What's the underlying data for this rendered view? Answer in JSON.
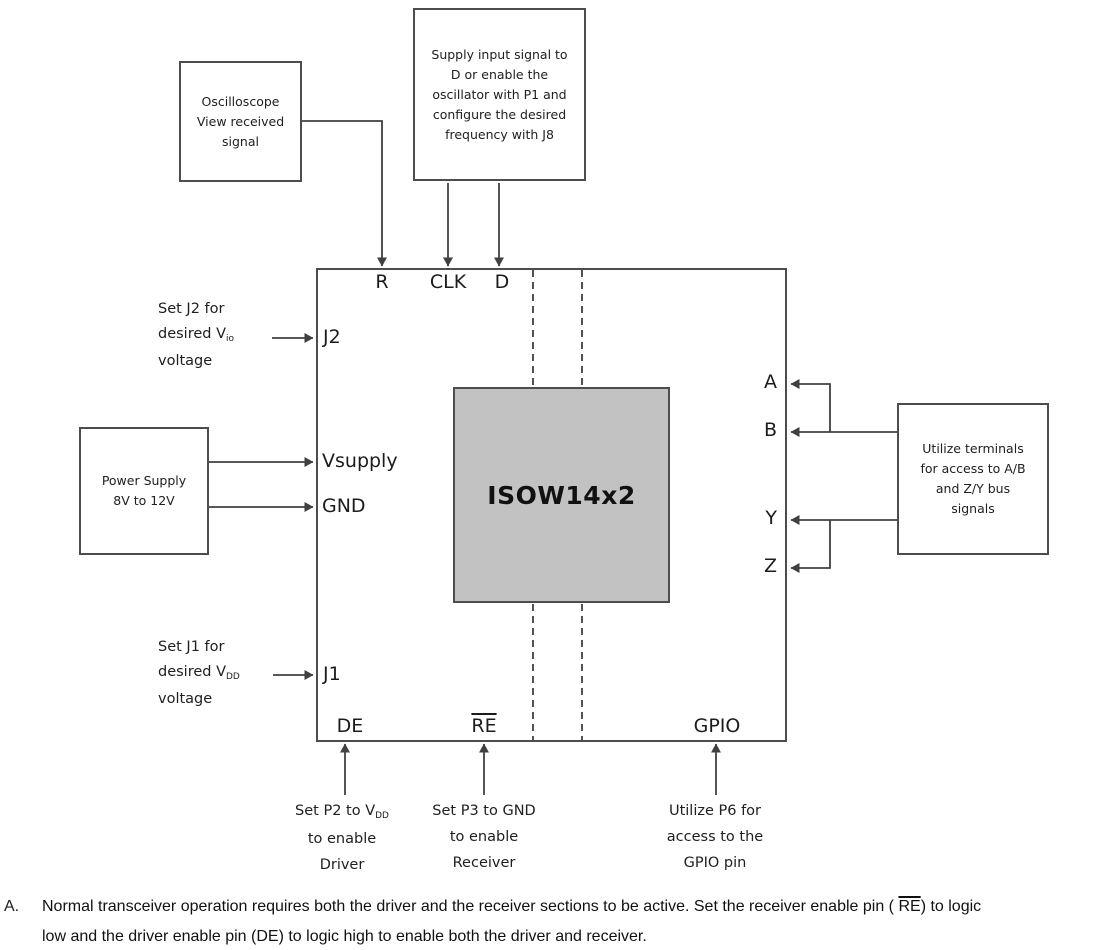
{
  "boxes": {
    "oscilloscope": {
      "lines": [
        "Oscilloscope",
        "View received",
        "signal"
      ]
    },
    "supply_input": {
      "lines": [
        "Supply input signal to",
        "D or enable the",
        "oscillator with P1 and",
        "configure the desired",
        "frequency with J8"
      ]
    },
    "power_supply": {
      "lines": [
        "Power Supply",
        "8V to 12V"
      ]
    },
    "bus_terminals": {
      "lines": [
        "Utilize terminals",
        "for access to A/B",
        "and Z/Y bus",
        "signals"
      ]
    },
    "chip": {
      "label": "ISOW14x2"
    }
  },
  "ports": {
    "r": "R",
    "clk": "CLK",
    "d": "D",
    "j2": "J2",
    "vsupply": "Vsupply",
    "gnd": "GND",
    "j1": "J1",
    "de": "DE",
    "re": "RE",
    "gpio": "GPIO",
    "a": "A",
    "b": "B",
    "y": "Y",
    "z": "Z"
  },
  "annotations": {
    "set_j2": {
      "line1": "Set J2 for",
      "line2_main": "desired V",
      "line2_sub": "io",
      "line3": "voltage"
    },
    "set_j1": {
      "line1": "Set J1 for",
      "line2_main": "desired V",
      "line2_sub": "DD",
      "line3": "voltage"
    },
    "set_p2": {
      "line1_main": "Set P2 to V",
      "line1_sub": "DD",
      "line2": "to enable",
      "line3": "Driver"
    },
    "set_p3": {
      "line1": "Set P3 to GND",
      "line2": "to enable",
      "line3": "Receiver"
    },
    "p6": {
      "line1": "Utilize P6 for",
      "line2": "access to the",
      "line3": "GPIO pin"
    }
  },
  "footnote": {
    "marker": "A.",
    "line1_pre": "Normal transceiver operation requires both the driver and the receiver sections to be active. Set the receiver enable pin ( ",
    "line1_re": "RE",
    "line1_post": ") to logic",
    "line2": "low and the driver enable pin (DE) to logic high to enable both the driver and receiver."
  },
  "colors": {
    "line": "#404040",
    "chip_fill": "#c2c2c2",
    "box_border": "#4d4d4d"
  }
}
